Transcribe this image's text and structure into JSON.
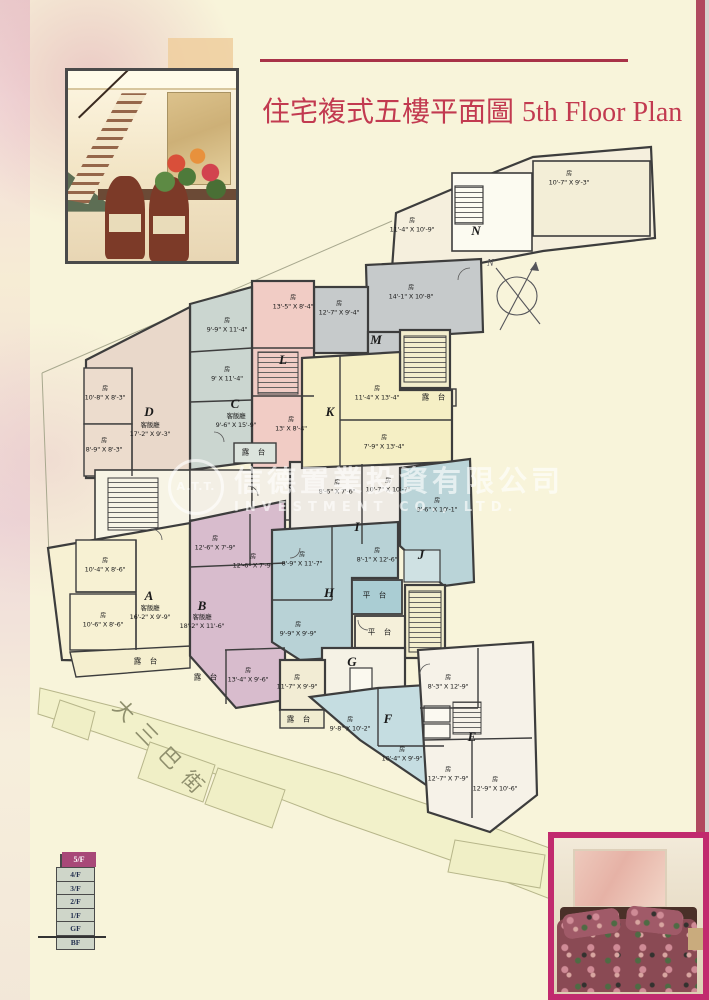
{
  "page": {
    "background": "#f8f4da",
    "accent": "#bf3a50",
    "stripe_color": "#b04a5f"
  },
  "title": {
    "cn": "住宅複式五樓平面圖",
    "en": "5th Floor Plan"
  },
  "watermark": {
    "logo": "A.T.T.",
    "cn": "信德置業投資有限公司",
    "en": "INVESTMENT CO., LTD."
  },
  "compass": {
    "label": "N"
  },
  "street": {
    "name": "大三巴街"
  },
  "floor_selector": {
    "active": "5/F",
    "floors": [
      "5/F",
      "4/F",
      "3/F",
      "2/F",
      "1/F",
      "GF",
      "BF"
    ]
  },
  "plan": {
    "room_glyph": "房",
    "living_label": "客飯廳",
    "balcony_label": "露 台",
    "terrace_label": "平 台",
    "units": {
      "A": "A",
      "B": "B",
      "C": "C",
      "D": "D",
      "E": "E",
      "F": "F",
      "G": "G",
      "H": "H",
      "I": "I",
      "J": "J",
      "K": "K",
      "L": "L",
      "M": "M",
      "N": "N"
    },
    "rooms": {
      "n1": "11'-4\" X 10'-9\"",
      "n2": "10'-7\" X 9'-3\"",
      "m1": "14'-1\" X 10'-8\"",
      "m2": "12'-7\" X 9'-4\"",
      "l1": "13'-5\" X 8'-4\"",
      "l2": "13' X 8'-4\"",
      "c1": "9'-9\" X 11'-4\"",
      "c2": "9' X 11'-4\"",
      "d1": "10'-8\" X 8'-3\"",
      "d2": "8'-9\" X 8'-3\"",
      "k1": "11'-4\" X 13'-4\"",
      "k2": "7'-9\" X 13'-4\"",
      "a1": "10'-4\" X 8'-6\"",
      "a2": "10'-6\" X 8'-6\"",
      "b1": "12'-6\" X 7'-9\"",
      "b2": "12'-6\" X 7'-9\"",
      "b3": "13'-4\" X 9'-6\"",
      "i1": "8'-6\" X 7'-6\"",
      "i2": "10'-7\" X 10'-7\"",
      "j1": "9'-6\" X 10'-1\"",
      "h1": "8'-9\" X 11'-7\"",
      "h2": "8'-1\" X 12'-6\"",
      "h3": "9'-9\" X 9'-9\"",
      "g1": "11'-7\" X 9'-9\"",
      "f1": "9'-8\" X 10'-2\"",
      "f2": "10'-4\" X 9'-9\"",
      "e1": "8'-3\" X 12'-9\"",
      "e2": "12'-7\" X 7'-9\"",
      "e3": "12'-9\" X 10'-6\""
    },
    "livings": {
      "a": "16'-2\" X 9'-9\"",
      "b": "18'-2\" X 11'-6\"",
      "c": "9'-6\" X 15'-9\"",
      "d": "17'-2\" X 9'-3\""
    }
  }
}
